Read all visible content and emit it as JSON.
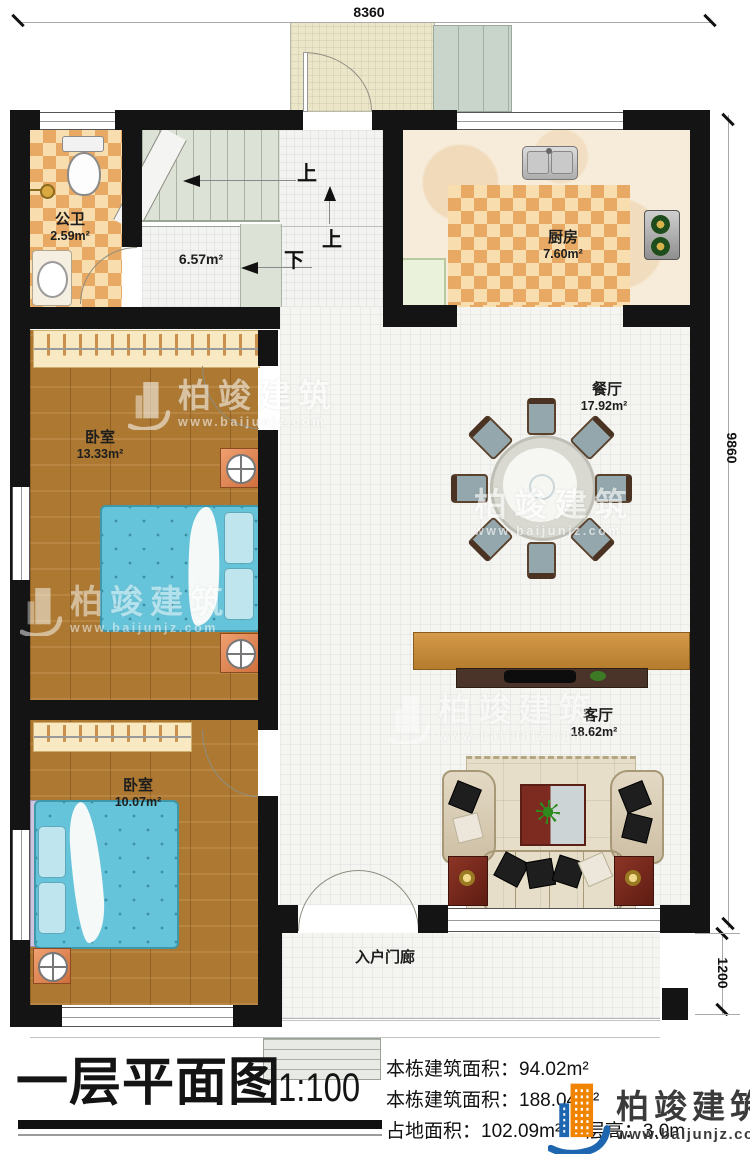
{
  "dimensions": {
    "top": "8360",
    "right_upper": "9860",
    "right_lower": "1200"
  },
  "rooms": {
    "bathroom": {
      "name": "公卫",
      "area": "2.59m²"
    },
    "stair_hall": {
      "area": "6.57m²"
    },
    "kitchen": {
      "name": "厨房",
      "area": "7.60m²"
    },
    "dining": {
      "name": "餐厅",
      "area": "17.92m²"
    },
    "bedroom1": {
      "name": "卧室",
      "area": "13.33m²"
    },
    "bedroom2": {
      "name": "卧室",
      "area": "10.07m²"
    },
    "living": {
      "name": "客厅",
      "area": "18.62m²"
    },
    "porch": {
      "name": "入户门廊"
    }
  },
  "stair_labels": {
    "up_a": "上",
    "up_b": "上",
    "down": "下"
  },
  "watermark": {
    "brand": "柏竣建筑",
    "url": "www.baijunjz.com"
  },
  "title_block": {
    "title": "一层平面图",
    "scale": "1:100",
    "stats": [
      {
        "label": "本栋建筑面积：",
        "value": "94.02m²"
      },
      {
        "label": "本栋建筑面积：",
        "value": "188.04m²"
      },
      {
        "label": "占地面积：",
        "value": "102.09m²"
      },
      {
        "label": "层高：",
        "value": "3.0m"
      }
    ]
  },
  "logo": {
    "brand": "柏竣建筑",
    "url": "www.baijunjz.com"
  }
}
